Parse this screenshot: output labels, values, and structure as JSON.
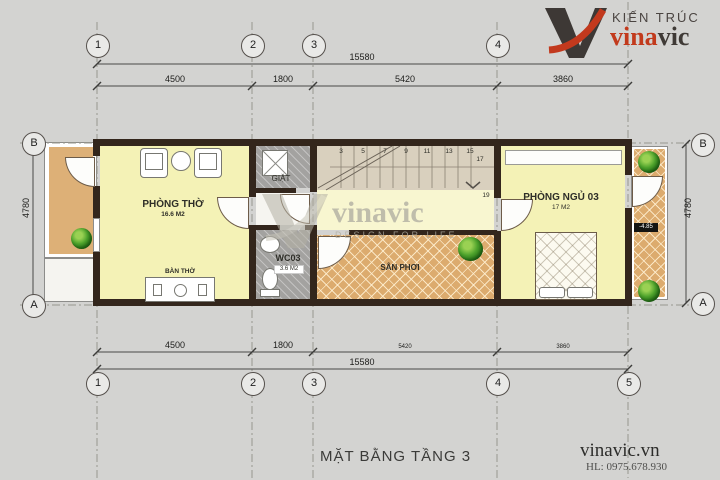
{
  "logo": {
    "tagline": "KIẾN TRÚC",
    "brand_red": "vina",
    "brand_dark": "vic"
  },
  "watermark": {
    "brand": "vinavic",
    "tagline": "DESIGN FOR LIFE"
  },
  "title": "MẶT BẰNG TẦNG 3",
  "footer": {
    "website": "vinavic.vn",
    "hotline": "HL: 0975.678.930"
  },
  "grid": {
    "top": [
      "1",
      "2",
      "3",
      "4"
    ],
    "bottom": [
      "1",
      "2",
      "3",
      "4",
      "5"
    ],
    "left": [
      "B",
      "A"
    ],
    "right": [
      "B",
      "A"
    ]
  },
  "dims": {
    "total": "15580",
    "segments": [
      "4500",
      "1800",
      "5420",
      "3860"
    ],
    "side": "4780"
  },
  "rooms": {
    "phong_tho": {
      "name": "PHÒNG THỜ",
      "area": "16.6 M2"
    },
    "giat": {
      "name": "GIẶT"
    },
    "wc": {
      "name": "WC03",
      "area": "3.6 M2"
    },
    "san_phoi": {
      "name": "SÂN PHƠI"
    },
    "phong_ngu": {
      "name": "PHÒNG NGỦ 03",
      "area": "17 M2"
    },
    "ban_tho": {
      "name": "BÀN THỜ"
    }
  },
  "stairs": {
    "numbers": [
      "3",
      "5",
      "7",
      "9",
      "11",
      "13",
      "15",
      "17",
      "19"
    ]
  },
  "annotations": {
    "level": "-4.85"
  },
  "colors": {
    "logo_red": "#c23a1c",
    "logo_dark": "#3f3a36",
    "wall": "#33261c",
    "room_yellow": "#f4f2b6",
    "balcony_tan": "#ddb077",
    "hatch_tan": "#dcab6e",
    "wc_gray": "#a3a2a0",
    "stair_beige": "#d9d0be",
    "corridor_yellow": "#f8f6d0",
    "background": "#d3d3d1"
  }
}
